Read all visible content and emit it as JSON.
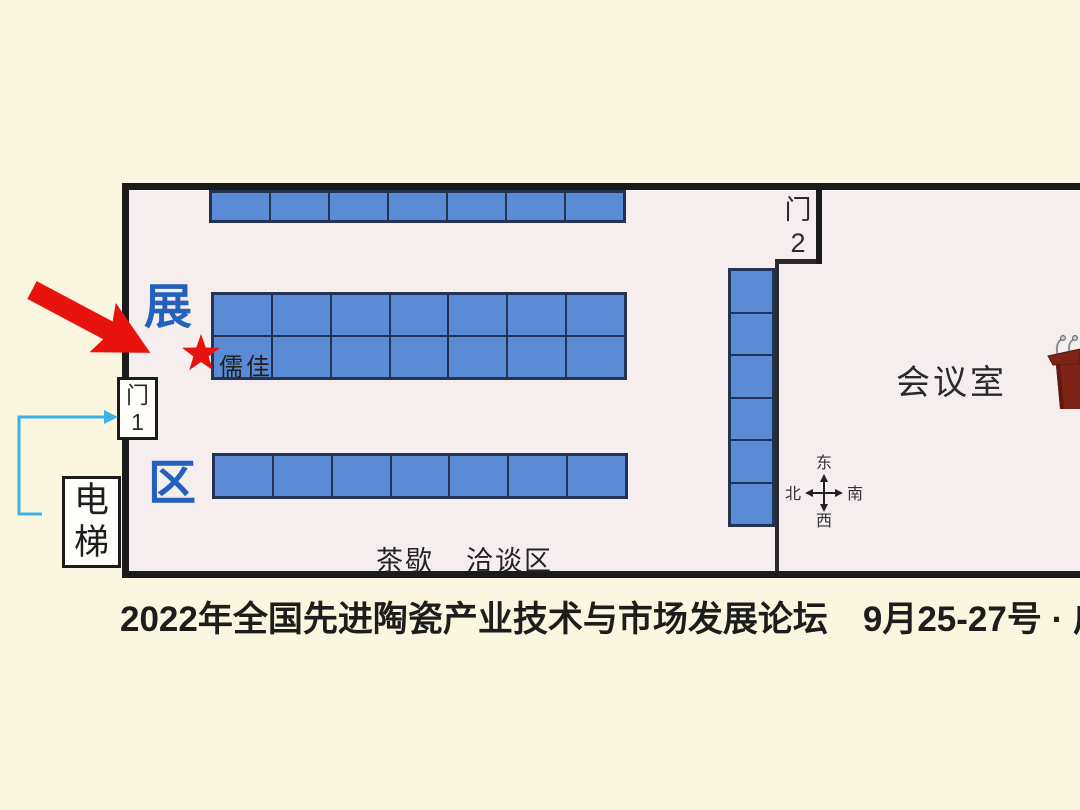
{
  "caption": "2022年全国先进陶瓷产业技术与市场发展论坛　9月25-27号 · 广",
  "plan": {
    "door1": {
      "line1": "门",
      "line2": "1"
    },
    "door2": {
      "line1": "门",
      "line2": "2"
    },
    "elevator": {
      "line1": "电",
      "line2": "梯"
    },
    "zone": {
      "char_top": "展",
      "char_bottom": "区"
    },
    "meeting_room": "会议室",
    "tea_break": "茶歇",
    "negotiation": "洽谈区",
    "highlight_booth": "儒佳",
    "compass": {
      "top": "东",
      "right": "南",
      "bottom": "西",
      "left": "北"
    },
    "booth_grids": [
      {
        "id": "top-row",
        "cols": 7,
        "rows": 1,
        "x": 209,
        "y": 190,
        "w": 417,
        "h": 33
      },
      {
        "id": "middle-block",
        "cols": 7,
        "rows": 2,
        "x": 211,
        "y": 292,
        "w": 416,
        "h": 88
      },
      {
        "id": "bottom-row",
        "cols": 7,
        "rows": 1,
        "x": 212,
        "y": 453,
        "w": 416,
        "h": 46
      },
      {
        "id": "door2-column",
        "cols": 1,
        "rows": 6,
        "x": 728,
        "y": 268,
        "w": 47,
        "h": 259
      }
    ]
  },
  "colors": {
    "booth_fill": "#5b8bd5",
    "booth_border": "#243253",
    "zone_text": "#2361bd",
    "highlight_red": "#e8120f",
    "route_cyan": "#3cb3e6",
    "podium_maroon": "#7e2417",
    "wall": "#1b1b1b",
    "floor": "#f6edee",
    "background": "#fbf6df"
  }
}
